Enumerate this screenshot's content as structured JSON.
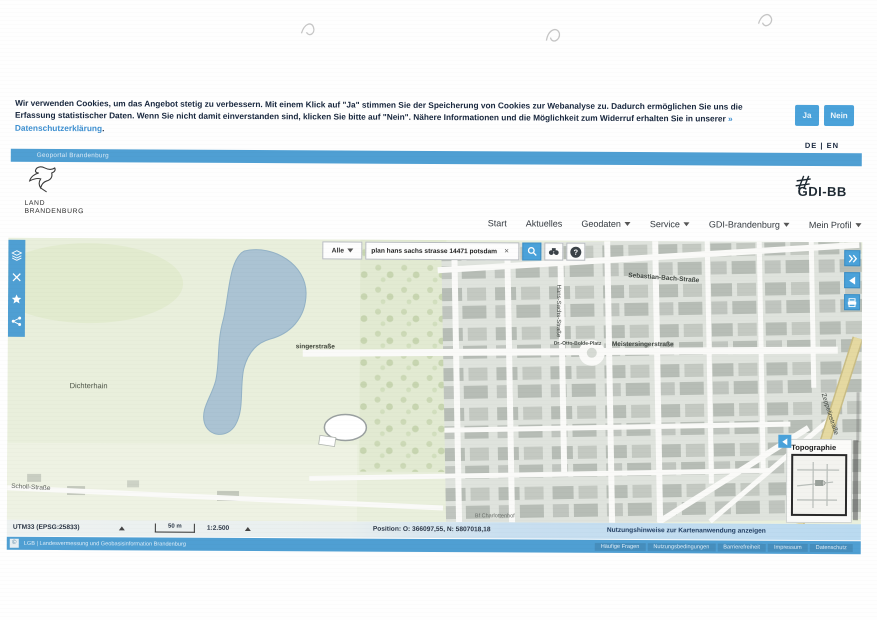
{
  "window": {
    "title": "Geoportal Brandenburg"
  },
  "cookie_banner": {
    "text": "Wir verwenden Cookies, um das Angebot stetig zu verbessern. Mit einem Klick auf \"Ja\" stimmen Sie der Speicherung von Cookies zur Webanalyse zu. Dadurch ermöglichen Sie uns die Erfassung statistischer Daten. Wenn Sie nicht damit einverstanden sind, klicken Sie bitte auf \"Nein\". Nähere Informationen und die Möglichkeit zum Widerruf erhalten Sie in unserer",
    "privacy_link": "» Datenschutzerklärung",
    "suffix": ".",
    "accept_label": "Ja",
    "decline_label": "Nein"
  },
  "language_switcher": {
    "de": "DE",
    "divider": "|",
    "en": "EN"
  },
  "top_bar": {
    "label": "Geoportal Brandenburg"
  },
  "branding": {
    "state_logo_line1": "LAND",
    "state_logo_line2": "BRANDENBURG",
    "gdi_logo_text": "GDI-BB"
  },
  "nav": {
    "items": [
      {
        "label": "Start"
      },
      {
        "label": "Aktuelles"
      },
      {
        "label": "Geodaten"
      },
      {
        "label": "Service"
      },
      {
        "label": "GDI-Brandenburg"
      },
      {
        "label": "Mein Profil"
      }
    ]
  },
  "search_bar": {
    "scope_selected": "Alle",
    "query": "plan hans sachs strasse 14471 potsdam",
    "clear_symbol": "×",
    "help_symbol": "?"
  },
  "map": {
    "labels": [
      {
        "text": "Dichterhain"
      },
      {
        "text": "Scholl-Straße"
      },
      {
        "text": "singerstraße"
      },
      {
        "text": "Dr.-Otto-Bolde-Platz"
      },
      {
        "text": "Meistersingerstraße"
      },
      {
        "text": "Hans-Sachs-Straße"
      },
      {
        "text": "Sebastian-Bach-Straße"
      },
      {
        "text": "Zeppelinstraße"
      },
      {
        "text": "Auf dem Kiewitt"
      },
      {
        "text": "Bf Charlottenhof"
      }
    ],
    "basemap_panel": {
      "title": "Topographie"
    }
  },
  "status_bar": {
    "crs": "UTM33 (EPSG:25833)",
    "scalebar_label": "50 m",
    "scale": "1:2.500",
    "position": "Position: O: 366097,55, N: 5807018,18",
    "usage_hint": "Nutzungshinweise zur Kartenanwendung anzeigen"
  },
  "footer": {
    "copyright_symbol": "©",
    "copyright": "LGB | Landesvermessung und Geobasisinformation Brandenburg",
    "links": [
      {
        "label": "Häufige Fragen"
      },
      {
        "label": "Nutzungsbedingungen"
      },
      {
        "label": "Barrierefreiheit"
      },
      {
        "label": "Impressum"
      },
      {
        "label": "Datenschutz"
      }
    ]
  },
  "colors": {
    "accent_blue": "#4f9fd3",
    "button_blue": "#4aa2da",
    "link_blue": "#3d8fd0"
  }
}
